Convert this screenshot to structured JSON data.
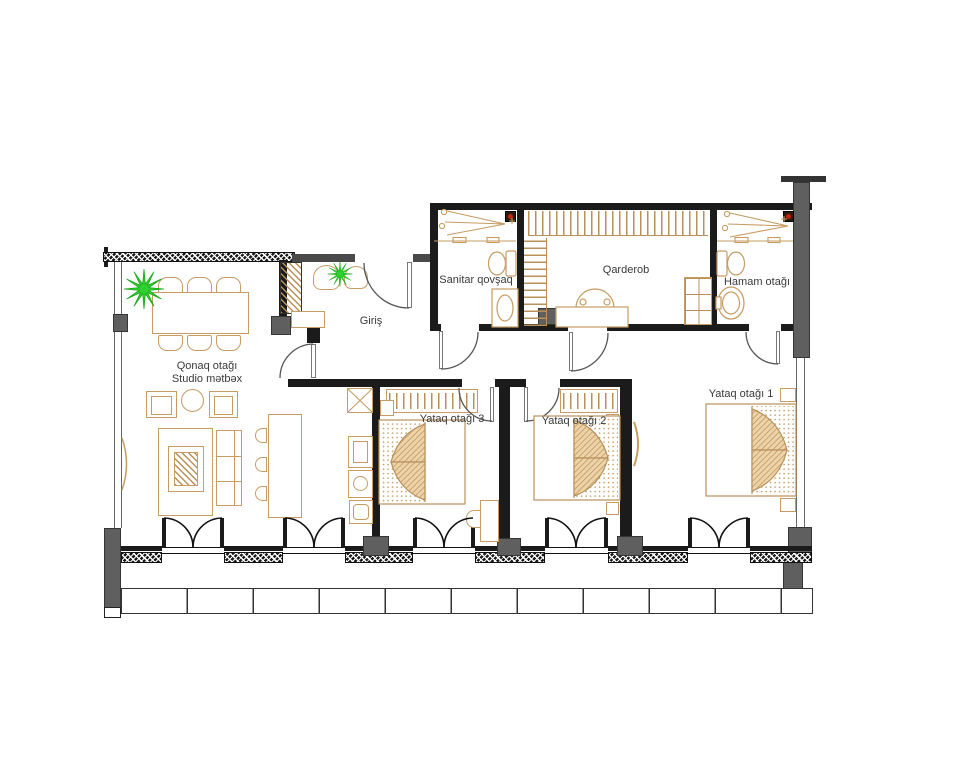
{
  "floorplan": {
    "rooms": {
      "living": {
        "label_line1": "Qonaq otağı",
        "label_line2": "Studio mətbəx"
      },
      "entrance": {
        "label": "Giriş"
      },
      "wc": {
        "label": "Sanitar qovşaq"
      },
      "wardrobe": {
        "label": "Qarderob"
      },
      "bathroom": {
        "label": "Hamam otağı"
      },
      "bedroom1": {
        "label": "Yataq otağı 1"
      },
      "bedroom2": {
        "label": "Yataq otağı 2"
      },
      "bedroom3": {
        "label": "Yataq otağı 3"
      }
    },
    "colors": {
      "wall": "#1b1b1b",
      "concrete": "#5f5f5f",
      "furniture_outline": "#c69c62",
      "plant_green": "#2fd02f",
      "label_text": "#3a3a3a",
      "background": "#ffffff"
    }
  }
}
